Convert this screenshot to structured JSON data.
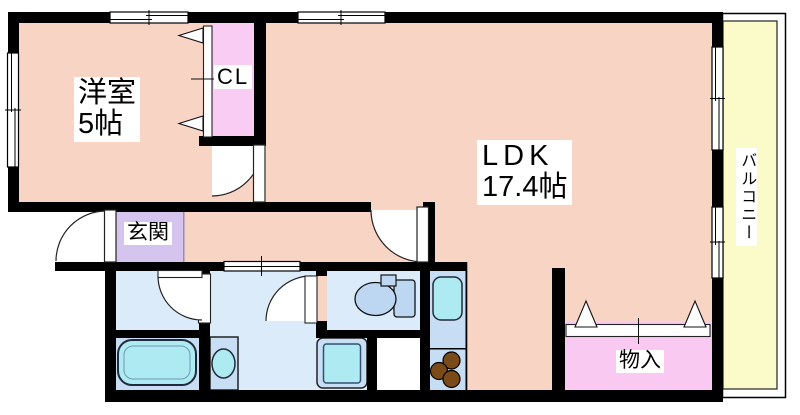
{
  "labels": {
    "bedroom_name": "洋室",
    "bedroom_size": "5帖",
    "closet": "CL",
    "ldk_name": "LDK",
    "ldk_size": "17.4帖",
    "entrance": "玄関",
    "storage": "物入",
    "balcony": "バルコニー"
  },
  "colors": {
    "wall": "#000000",
    "room": "#f8d4c5",
    "closet": "#f9cdf3",
    "storage": "#f9c9f2",
    "entrance": "#d5c5ee",
    "washroom": "#dcebfa",
    "bath": "#c6ddf4",
    "fixture": "#aeeaf2",
    "fixture_unit": "#c8def5",
    "toilet": "#bdd7f2",
    "balcony": "#fbfbca",
    "burner": "#7a4a18"
  }
}
